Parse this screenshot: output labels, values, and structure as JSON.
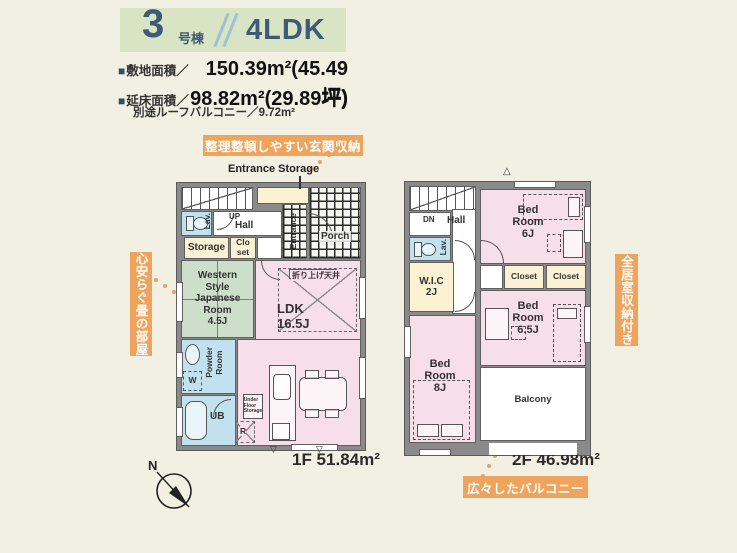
{
  "header": {
    "unit_number": "3",
    "unit_suffix": "号棟",
    "plan_type": "4LDK",
    "bullet": "■",
    "site_area_label": "敷地面積／",
    "site_area_value": "150.39m²(45.49坪)",
    "floor_area_label": "延床面積／",
    "floor_area_value": "98.82m²(29.89坪)",
    "note": "別途ルーフバルコニー／9.72m²"
  },
  "annotations": {
    "entrance_storage": "整理整頓しやすい玄関収納",
    "tatami_room": "心安らぐ畳の部屋",
    "all_rooms_storage": "全居室収納付き",
    "balcony": "広々したバルコニー"
  },
  "floor1": {
    "area_label": "1F 51.84m²",
    "entrance_storage_caption": "Entrance Storage",
    "rooms": {
      "up": "UP",
      "hall": "Hall",
      "lav": "Lav.",
      "storage": "Storage",
      "closet": "Clo\nset",
      "japanese": "Western\nStyle\nJapanese\nRoom\n4.5J",
      "ldk": "LDK\n16.5J",
      "raised_ceiling": "折り上げ天井",
      "powder": "Powder\nRoom",
      "ub": "UB",
      "entrance": "Entrance",
      "porch": "Porch",
      "under_floor": "Under\nFloor\nStorage",
      "fridge": "R",
      "washer": "W"
    }
  },
  "floor2": {
    "area_label": "2F 46.98m²",
    "rooms": {
      "dn": "DN",
      "hall": "Hall",
      "lav": "Lav.",
      "wic": "W.I.C\n2J",
      "bed6": "Bed\nRoom\n6J",
      "closet_a": "Closet",
      "closet_b": "Closet",
      "bed65": "Bed\nRoom\n6.5J",
      "bed8": "Bed\nRoom\n8J",
      "balcony": "Balcony"
    }
  },
  "compass": {
    "north": "N"
  },
  "colors": {
    "accent_orange": "#efa45e",
    "header_green": "#d8e4c3",
    "title_navy": "#3e5a76",
    "room_pink": "#f7dfe9",
    "room_green": "#cddfca",
    "room_cream": "#faf2d2",
    "room_blue": "#c2e1ee",
    "wall_gray": "#8a8a8a",
    "background": "#f2f0e3"
  }
}
